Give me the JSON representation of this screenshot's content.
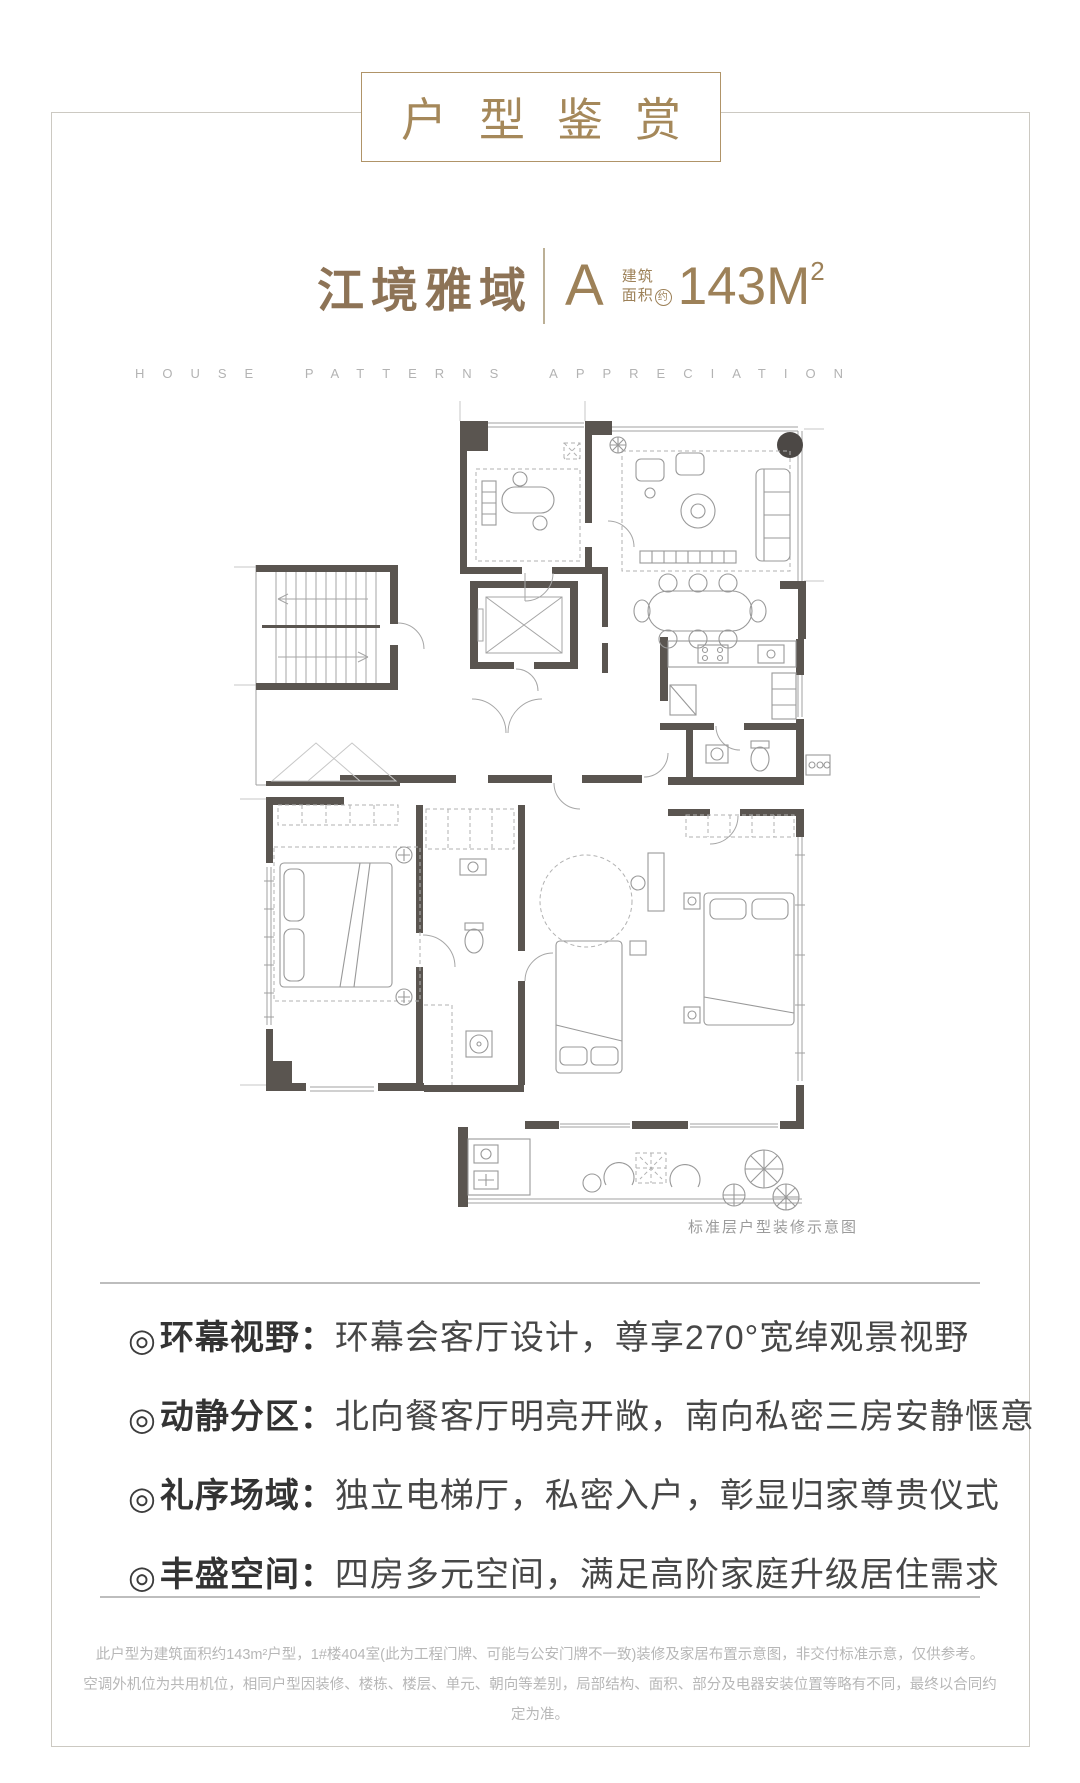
{
  "header": {
    "title": "户型鉴赏",
    "english": "HOUSE PATTERNS APPRECIATION"
  },
  "subtitle": {
    "name": "江境雅域",
    "unit": "A",
    "area_label_line1": "建筑",
    "area_label_line2": "面积",
    "area_label_circled": "约",
    "area_value": "143M",
    "area_sup": "2"
  },
  "floorplan": {
    "caption": "标准层户型装修示意图"
  },
  "features": [
    {
      "marker": "◎",
      "label": "环幕视野",
      "sep": "：",
      "text": "环幕会客厅设计，尊享270°宽绰观景视野"
    },
    {
      "marker": "◎",
      "label": "动静分区",
      "sep": "：",
      "text": "北向餐客厅明亮开敞，南向私密三房安静惬意"
    },
    {
      "marker": "◎",
      "label": "礼序场域",
      "sep": "：",
      "text": "独立电梯厅，私密入户，彰显归家尊贵仪式"
    },
    {
      "marker": "◎",
      "label": "丰盛空间",
      "sep": "：",
      "text": "四房多元空间，满足高阶家庭升级居住需求"
    }
  ],
  "disclaimer": {
    "line1": "此户型为建筑面积约143m²户型，1#楼404室(此为工程门牌、可能与公安门牌不一致)装修及家居布置示意图，非交付标准示意，仅供参考。",
    "line2": "空调外机位为共用机位，相同户型因装修、楼栋、楼层、单元、朝向等差别，局部结构、面积、部分及电器安装位置等略有不同，最终以合同约定为准。"
  },
  "colors": {
    "accent_bronze": "#a5885a",
    "subtitle_bronze": "#9d8158",
    "wall_gray": "#5a5550",
    "text_dark": "#3f3f3f",
    "muted_gray": "#b5b5b5",
    "frame_gray": "#ccc9c2"
  }
}
